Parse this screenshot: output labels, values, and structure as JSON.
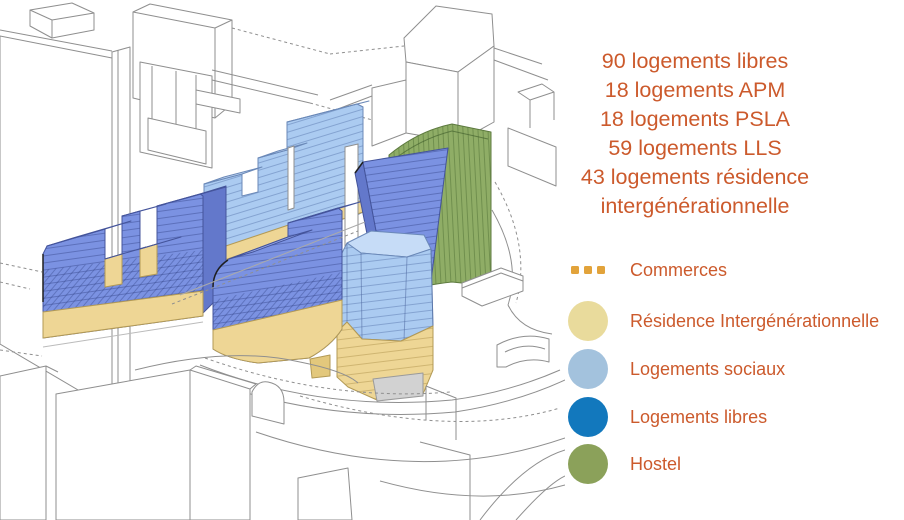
{
  "stats": {
    "lines": [
      "90 logements libres",
      "18 logements APM",
      "18 logements PSLA",
      "59 logements LLS",
      "43 logements résidence",
      "intergénérationnelle"
    ]
  },
  "legend": {
    "items": [
      {
        "label": "Commerces",
        "swatch": "dots",
        "color": "#e2a33b"
      },
      {
        "label": "Résidence Intergénérationnelle",
        "swatch": "circle",
        "color": "#e9db9c"
      },
      {
        "label": "Logements sociaux",
        "swatch": "circle",
        "color": "#a3c2dd"
      },
      {
        "label": "Logements libres",
        "swatch": "circle",
        "color": "#1278bd"
      },
      {
        "label": "Hostel",
        "swatch": "circle",
        "color": "#8ba15a"
      }
    ]
  },
  "colors": {
    "accent_text": "#cc5a2c",
    "bldg_libres": "#7b92e2",
    "bldg_libres_roof": "#97aaec",
    "bldg_libres_side": "#6378cb",
    "bldg_sociaux": "#abcbf1",
    "bldg_sociaux_roof": "#c6dcf7",
    "bldg_sociaux_side": "#90b3de",
    "bldg_residence": "#eed695",
    "bldg_residence_dark": "#e3c87c",
    "bldg_hostel": "#8fad66",
    "bldg_gray": "#d2d2d2",
    "wire_line": "#8f8f8f"
  }
}
